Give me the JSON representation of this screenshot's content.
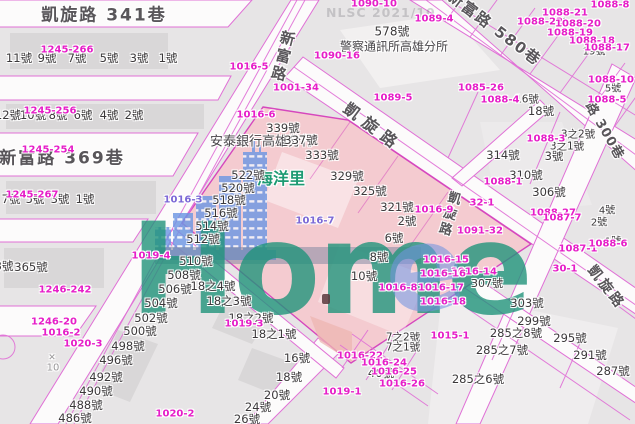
{
  "watermark": {
    "brand": "Home",
    "agency": "NLSC 2021/10"
  },
  "colors": {
    "parcel_label": "#e61ec8",
    "house_label": "#3b383a",
    "street_label": "#59565a",
    "district_label": "#1d9a72",
    "pink_block": "#f5c9ce",
    "road_line": "#e070d6",
    "watermark_teal": "#209a7a",
    "watermark_blue": "#6d97e3",
    "ground_bar": "#79849e"
  },
  "map": {
    "streets": [
      {
        "t": "凱旋路 341巷",
        "x": 104,
        "y": 13,
        "s": 17,
        "c": "h"
      },
      {
        "t": "新富路 369巷",
        "x": 62,
        "y": 156,
        "s": 17,
        "c": "h"
      },
      {
        "t": "新富路",
        "x": 283,
        "y": 57,
        "s": 15,
        "v": true,
        "r": 14
      },
      {
        "t": "凱旋路",
        "x": 374,
        "y": 126,
        "s": 16,
        "r": 37,
        "ls": 7
      },
      {
        "t": "新富路 580巷",
        "x": 495,
        "y": 28,
        "s": 15,
        "r": 37,
        "ls": 2
      },
      {
        "t": "路 300巷",
        "x": 606,
        "y": 130,
        "s": 13,
        "r": 60,
        "ls": 1
      },
      {
        "t": "凱旋路",
        "x": 607,
        "y": 287,
        "s": 14,
        "r": 52,
        "ls": 3
      },
      {
        "t": "凱旋路",
        "x": 448,
        "y": 214,
        "s": 13,
        "v": true,
        "r": 16
      }
    ],
    "pois": [
      {
        "t": "警察通訊所高雄分所",
        "x": 394,
        "y": 46,
        "s": 12
      },
      {
        "t": "安泰銀行高雄分行",
        "x": 262,
        "y": 140,
        "s": 13
      },
      {
        "t": "海洋里",
        "x": 281,
        "y": 177,
        "c": "district"
      }
    ],
    "houses": [
      {
        "t": "11號",
        "x": 19,
        "y": 58
      },
      {
        "t": "9號",
        "x": 47,
        "y": 58
      },
      {
        "t": "7號",
        "x": 77,
        "y": 58
      },
      {
        "t": "5號",
        "x": 109,
        "y": 58
      },
      {
        "t": "3號",
        "x": 139,
        "y": 58
      },
      {
        "t": "1號",
        "x": 168,
        "y": 58
      },
      {
        "t": "12號",
        "x": 8,
        "y": 115
      },
      {
        "t": "10號",
        "x": 33,
        "y": 115
      },
      {
        "t": "8號",
        "x": 58,
        "y": 115
      },
      {
        "t": "6號",
        "x": 83,
        "y": 115
      },
      {
        "t": "4號",
        "x": 109,
        "y": 115
      },
      {
        "t": "2號",
        "x": 134,
        "y": 115
      },
      {
        "t": "7號",
        "x": 11,
        "y": 199
      },
      {
        "t": "5號",
        "x": 35,
        "y": 199
      },
      {
        "t": "3號",
        "x": 60,
        "y": 199
      },
      {
        "t": "1號",
        "x": 85,
        "y": 199
      },
      {
        "t": "3號",
        "x": 4,
        "y": 266
      },
      {
        "t": "365號",
        "x": 31,
        "y": 267
      },
      {
        "t": "578號",
        "x": 392,
        "y": 31,
        "s": 12
      },
      {
        "t": "18號",
        "x": 541,
        "y": 111
      },
      {
        "t": "339號",
        "x": 283,
        "y": 128
      },
      {
        "t": "337號",
        "x": 301,
        "y": 140
      },
      {
        "t": "333號",
        "x": 322,
        "y": 155
      },
      {
        "t": "329號",
        "x": 347,
        "y": 176
      },
      {
        "t": "325號",
        "x": 370,
        "y": 191
      },
      {
        "t": "321號",
        "x": 397,
        "y": 207
      },
      {
        "t": "314號",
        "x": 503,
        "y": 155
      },
      {
        "t": "3號",
        "x": 554,
        "y": 156
      },
      {
        "t": "3之1號",
        "x": 567,
        "y": 146,
        "s": 10.5
      },
      {
        "t": "3之2號",
        "x": 578,
        "y": 134,
        "s": 10.5
      },
      {
        "t": "310號",
        "x": 526,
        "y": 175
      },
      {
        "t": "306號",
        "x": 549,
        "y": 192
      },
      {
        "t": "2號",
        "x": 407,
        "y": 221
      },
      {
        "t": "6號",
        "x": 394,
        "y": 238
      },
      {
        "t": "8號",
        "x": 379,
        "y": 257
      },
      {
        "t": "10號",
        "x": 364,
        "y": 276
      },
      {
        "t": "19號",
        "x": 594,
        "y": 50,
        "s": 10
      },
      {
        "t": "5號",
        "x": 613,
        "y": 87,
        "s": 10
      },
      {
        "t": "16號",
        "x": 527,
        "y": 99,
        "s": 10.5
      },
      {
        "t": "1號",
        "x": 558,
        "y": 18,
        "s": 10,
        "r": 36
      },
      {
        "t": "4號",
        "x": 607,
        "y": 209,
        "s": 10
      },
      {
        "t": "2號",
        "x": 599,
        "y": 221,
        "s": 10
      },
      {
        "t": "1號",
        "x": 613,
        "y": 240,
        "s": 10
      },
      {
        "t": "522號",
        "x": 248,
        "y": 175
      },
      {
        "t": "520號",
        "x": 238,
        "y": 188
      },
      {
        "t": "518號",
        "x": 229,
        "y": 200
      },
      {
        "t": "516號",
        "x": 221,
        "y": 213
      },
      {
        "t": "514號",
        "x": 212,
        "y": 226
      },
      {
        "t": "512號",
        "x": 203,
        "y": 239
      },
      {
        "t": "510號",
        "x": 196,
        "y": 261
      },
      {
        "t": "508號",
        "x": 184,
        "y": 275
      },
      {
        "t": "506號",
        "x": 175,
        "y": 289
      },
      {
        "t": "504號",
        "x": 161,
        "y": 303
      },
      {
        "t": "502號",
        "x": 151,
        "y": 318
      },
      {
        "t": "500號",
        "x": 140,
        "y": 331
      },
      {
        "t": "498號",
        "x": 128,
        "y": 346
      },
      {
        "t": "496號",
        "x": 116,
        "y": 360
      },
      {
        "t": "492號",
        "x": 106,
        "y": 377
      },
      {
        "t": "490號",
        "x": 96,
        "y": 391
      },
      {
        "t": "488號",
        "x": 86,
        "y": 405
      },
      {
        "t": "486號",
        "x": 75,
        "y": 418
      },
      {
        "t": "18之4號",
        "x": 213,
        "y": 286
      },
      {
        "t": "18之3號",
        "x": 229,
        "y": 301
      },
      {
        "t": "18之2號",
        "x": 251,
        "y": 318
      },
      {
        "t": "18之1號",
        "x": 274,
        "y": 334
      },
      {
        "t": "16號",
        "x": 297,
        "y": 358
      },
      {
        "t": "18號",
        "x": 289,
        "y": 377
      },
      {
        "t": "20號",
        "x": 277,
        "y": 395
      },
      {
        "t": "24號",
        "x": 258,
        "y": 407
      },
      {
        "t": "26號",
        "x": 247,
        "y": 419
      },
      {
        "t": "40號",
        "x": 381,
        "y": 373
      },
      {
        "t": "7之2號",
        "x": 403,
        "y": 337,
        "s": 10.5
      },
      {
        "t": "7之1號",
        "x": 403,
        "y": 347,
        "s": 10.5
      },
      {
        "t": "307號",
        "x": 487,
        "y": 283,
        "s": 11
      },
      {
        "t": "303號",
        "x": 527,
        "y": 303
      },
      {
        "t": "299號",
        "x": 534,
        "y": 321
      },
      {
        "t": "295號",
        "x": 570,
        "y": 338
      },
      {
        "t": "291號",
        "x": 590,
        "y": 355
      },
      {
        "t": "287號",
        "x": 613,
        "y": 371
      },
      {
        "t": "285之8號",
        "x": 516,
        "y": 333
      },
      {
        "t": "285之7號",
        "x": 502,
        "y": 350
      },
      {
        "t": "285之6號",
        "x": 478,
        "y": 379
      }
    ],
    "parcels": [
      {
        "t": "1245-266",
        "x": 67,
        "y": 50
      },
      {
        "t": "1245-256",
        "x": 50,
        "y": 111
      },
      {
        "t": "1245-254",
        "x": 48,
        "y": 150
      },
      {
        "t": "1245-267",
        "x": 32,
        "y": 195
      },
      {
        "t": "1246-242",
        "x": 65,
        "y": 290
      },
      {
        "t": "1019-4",
        "x": 151,
        "y": 256
      },
      {
        "t": "1246-20",
        "x": 54,
        "y": 322
      },
      {
        "t": "1016-2",
        "x": 61,
        "y": 333
      },
      {
        "t": "1020-3",
        "x": 83,
        "y": 344
      },
      {
        "t": "1020-2",
        "x": 175,
        "y": 414
      },
      {
        "t": "1019-3",
        "x": 244,
        "y": 324
      },
      {
        "t": "1019-1",
        "x": 342,
        "y": 392
      },
      {
        "t": "1016-22",
        "x": 360,
        "y": 356
      },
      {
        "t": "1016-24",
        "x": 384,
        "y": 363
      },
      {
        "t": "1016-25",
        "x": 394,
        "y": 372
      },
      {
        "t": "1016-26",
        "x": 402,
        "y": 384
      },
      {
        "t": "1090-10",
        "x": 374,
        "y": 4
      },
      {
        "t": "1089-4",
        "x": 434,
        "y": 19
      },
      {
        "t": "1090-16",
        "x": 337,
        "y": 56
      },
      {
        "t": "1001-34",
        "x": 296,
        "y": 88
      },
      {
        "t": "1089-5",
        "x": 393,
        "y": 98
      },
      {
        "t": "1016-5",
        "x": 249,
        "y": 67
      },
      {
        "t": "1016-6",
        "x": 256,
        "y": 115
      },
      {
        "t": "1016-7",
        "x": 315,
        "y": 221,
        "c": "purple"
      },
      {
        "t": "1016-3",
        "x": 183,
        "y": 200,
        "c": "purple"
      },
      {
        "t": "1016-8",
        "x": 398,
        "y": 288
      },
      {
        "t": "1016-9",
        "x": 434,
        "y": 210
      },
      {
        "t": "1088-8",
        "x": 610,
        "y": 5
      },
      {
        "t": "1088-21",
        "x": 565,
        "y": 13
      },
      {
        "t": "1088-22",
        "x": 540,
        "y": 22
      },
      {
        "t": "1088-20",
        "x": 578,
        "y": 24
      },
      {
        "t": "1088-19",
        "x": 570,
        "y": 33
      },
      {
        "t": "1088-18",
        "x": 592,
        "y": 41
      },
      {
        "t": "1088-17",
        "x": 607,
        "y": 48
      },
      {
        "t": "1088-10",
        "x": 611,
        "y": 80
      },
      {
        "t": "1085-26",
        "x": 481,
        "y": 88
      },
      {
        "t": "1088-4",
        "x": 500,
        "y": 100
      },
      {
        "t": "1088-5",
        "x": 607,
        "y": 100
      },
      {
        "t": "1088-3",
        "x": 546,
        "y": 139
      },
      {
        "t": "1088-1",
        "x": 503,
        "y": 182
      },
      {
        "t": "32-1",
        "x": 482,
        "y": 203
      },
      {
        "t": "1091-32",
        "x": 480,
        "y": 231
      },
      {
        "t": "1016-14",
        "x": 474,
        "y": 272
      },
      {
        "t": "1016-15",
        "x": 446,
        "y": 260
      },
      {
        "t": "1016-16",
        "x": 443,
        "y": 274
      },
      {
        "t": "1016-17",
        "x": 441,
        "y": 288
      },
      {
        "t": "1016-18",
        "x": 443,
        "y": 302
      },
      {
        "t": "1088-27",
        "x": 553,
        "y": 213
      },
      {
        "t": "1087-7",
        "x": 562,
        "y": 218
      },
      {
        "t": "1087-1",
        "x": 578,
        "y": 249
      },
      {
        "t": "30-1",
        "x": 565,
        "y": 269
      },
      {
        "t": "1088-6",
        "x": 608,
        "y": 244
      },
      {
        "t": "1015-1",
        "x": 450,
        "y": 336
      }
    ],
    "misc": [
      {
        "t": "✕",
        "x": 52,
        "y": 358,
        "s": 9
      },
      {
        "t": "10",
        "x": 53,
        "y": 368
      }
    ]
  }
}
